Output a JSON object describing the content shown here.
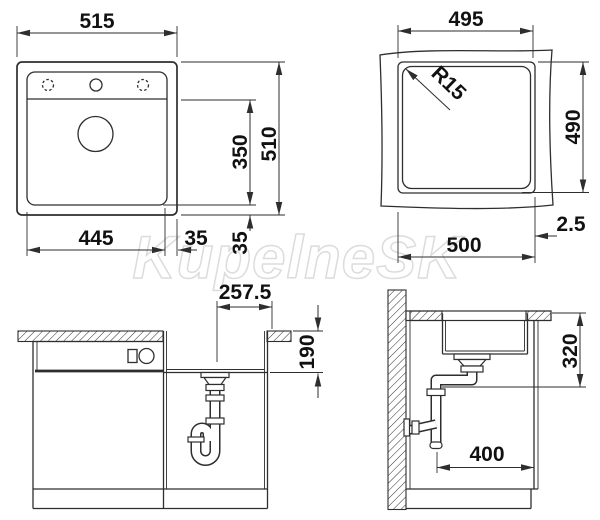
{
  "watermark": "KupelneSK",
  "colors": {
    "line": "#2e2e2e",
    "text": "#111111",
    "watermark_outline": "#dcdcde",
    "background": "#ffffff"
  },
  "views": {
    "sink_top": {
      "overall_width": "515",
      "overall_height": "510",
      "bowl_width": "445",
      "bowl_inner_height": "350",
      "side_margin": "35",
      "bottom_margin": "35"
    },
    "cutout": {
      "top_width": "495",
      "corner_radius": "R15",
      "height": "490",
      "bottom_width": "500",
      "edge_gap": "2.5"
    },
    "cabinet_front": {
      "center_to_edge": "257.5",
      "bowl_depth": "190"
    },
    "cabinet_side": {
      "outlet_height": "320",
      "outlet_offset": "400"
    }
  }
}
